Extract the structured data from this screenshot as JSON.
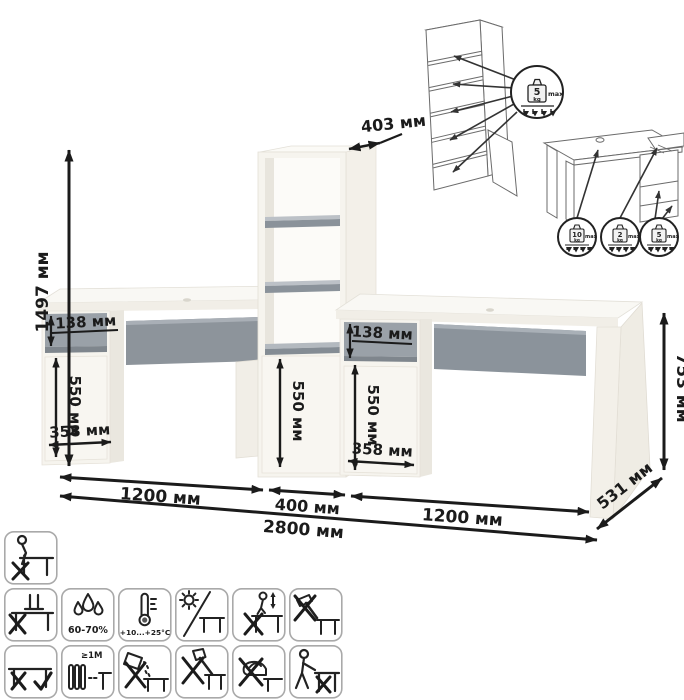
{
  "diagram": {
    "dims": {
      "overall_height": "1497 мм",
      "overall_width": "2800 мм",
      "desk_height": "753 мм",
      "desk_depth": "531 мм",
      "bookcase_depth": "403 мм",
      "bookcase_width": "400 мм",
      "left_desk_width": "1200 мм",
      "right_desk_width": "1200 мм",
      "drawer_front_height": "138 мм",
      "door_height": "550 мм",
      "door_width": "358 мм"
    },
    "load_limits": {
      "unit": "kg",
      "max_label": "max",
      "bookcase_shelf_kg": "5",
      "desktop_kg": "10",
      "drawer_kg": "2",
      "pedestal_shelf_kg": "5"
    },
    "care": {
      "humidity": "60-70%",
      "temperature": "+10...+25°C",
      "heater_distance": "≥1M"
    },
    "care_icon_names": [
      "do-not-sit-on-surface",
      "do-not-stand-on-surface",
      "humidity-60-70",
      "temperature-plus10-plus25",
      "avoid-direct-sunlight",
      "do-not-jump-on-surface",
      "no-hammer-impacts",
      "lift-do-not-drag",
      "keep-1m-from-heaters",
      "do-not-spill-liquids",
      "no-sharp-tools",
      "no-hot-objects",
      "do-not-drag-alone"
    ],
    "colors": {
      "furniture_white": "#f6f4ee",
      "gray_accent": "#8d949b",
      "dimension_line": "#1b1b1b"
    }
  }
}
